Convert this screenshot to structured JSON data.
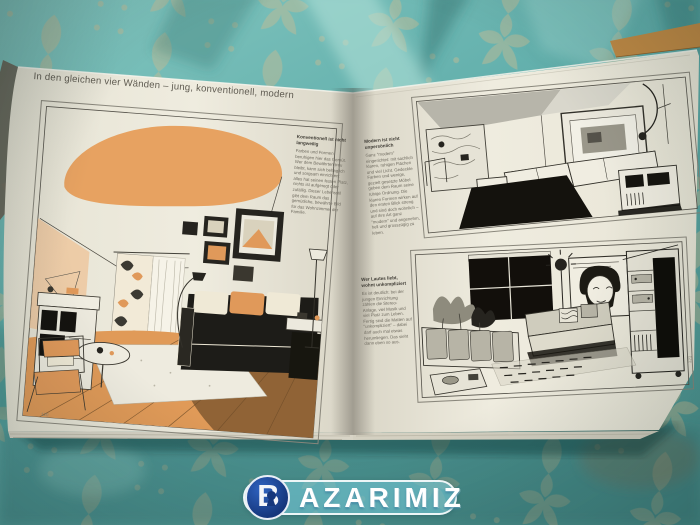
{
  "book": {
    "header": "In den gleichen vier Wänden – jung, konventionell, modern",
    "left_page": {
      "page_number": "120",
      "article": {
        "heading": "Konventionell ist nicht langweilig",
        "body": "Farben und Formen beruhigen hier das Gemüt. Wer dem Bewährten treu bleibt, kann sich behaglich und sorgsam einrichten: alles hat seinen festen Platz, nichts ist aufgeregt oder zufällig. Dieser Lebensstil gibt dem Raum das gemütliche, bewährte Bild für das Wohnzimmer der Familie."
      }
    },
    "right_page": {
      "page_number": "121",
      "article_modern": {
        "heading": "Modern ist nicht unpersönlich",
        "body": "Ganz \"modern\" eingerichtet: mit sachlich klaren, ruhigen Flächen und viel Licht. Gedeckte Farben und wenige, gezielt gesetzte Möbel geben dem Raum seine ruhige Ordnung. Die klaren Formen wirken auf den ersten Blick streng und sind doch wohnlich – auf ihre Art ganz \"modern\" und angenehm, hell und grosszügig zu leben."
      },
      "article_young": {
        "heading": "Wer Lautes liebt, wohnt unkompliziert",
        "body": "Es ist deutlich: bei der jungen Einrichtung zählen die Stereo-Anlage, viel Musik und viel Platz zum Leben. Fertig sind die Matten auf \"unkompliziert\" – dabei darf auch mal etwas herumliegen. Das sieht dann eben so aus."
      }
    }
  },
  "watermark": {
    "brand": "BAZARIMIZ",
    "initial": "B",
    "rest": "AZARIMIZ"
  },
  "colors": {
    "fabric_teal": "#5aa7a3",
    "damask_beige": "#c9bb92",
    "page_cream": "#ece9dd",
    "illustration_orange": "#e09a58",
    "ink_black": "#1d1c18",
    "badge_blue": "#16377c",
    "pill_blue": "#7dcdde"
  }
}
